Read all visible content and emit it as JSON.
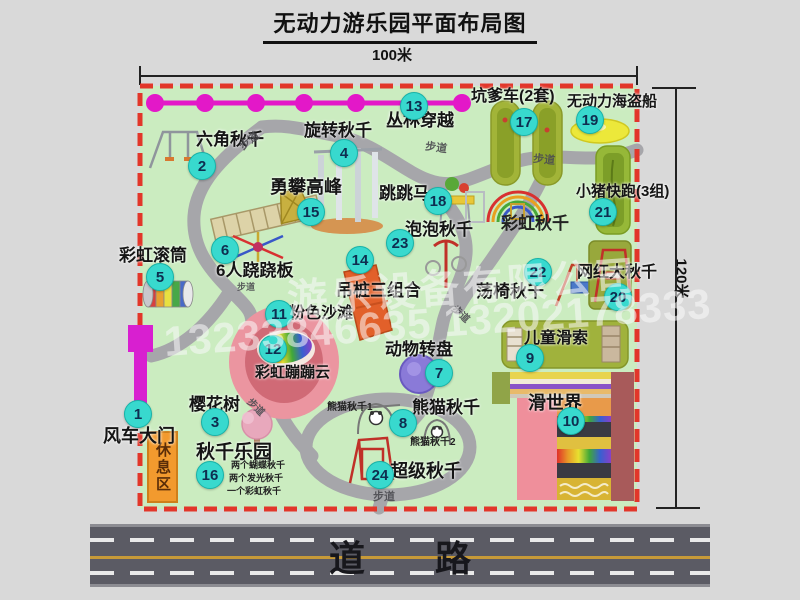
{
  "title": "无动力游乐园平面布局图",
  "dimensions": {
    "top": "100米",
    "right": "120米"
  },
  "road": {
    "label": "道路"
  },
  "rest_area": {
    "label": "休息区"
  },
  "watermark": {
    "line1": "游乐设备有限公司",
    "line2": "13233846635 13202178333"
  },
  "colors": {
    "park_fill": "#cbecc0",
    "boundary": "#e2362a",
    "badge": "#38d9ce",
    "walkway": "#a6a6aa",
    "zipline": "#e318c8",
    "road": "#5b5b64",
    "gate": "#d81fd0",
    "rest_area": "#f29a2e"
  },
  "attractions": [
    {
      "num": 1,
      "label": "风车大门",
      "lx": 103,
      "ly": 427,
      "size": 18,
      "bx": 137,
      "by": 413
    },
    {
      "num": 2,
      "label": "六角秋千",
      "lx": 196,
      "ly": 131,
      "size": 17,
      "bx": 201,
      "by": 165
    },
    {
      "num": 3,
      "label": "樱花树",
      "lx": 189,
      "ly": 396,
      "size": 17,
      "bx": 214,
      "by": 421
    },
    {
      "num": 4,
      "label": "旋转秋千",
      "lx": 304,
      "ly": 122,
      "size": 17,
      "bx": 343,
      "by": 152
    },
    {
      "num": 5,
      "label": "彩虹滚筒",
      "lx": 119,
      "ly": 247,
      "size": 17,
      "bx": 159,
      "by": 276
    },
    {
      "num": 6,
      "label": "6人跷跷板",
      "lx": 216,
      "ly": 262,
      "size": 17,
      "bx": 224,
      "by": 249
    },
    {
      "num": 7,
      "label": "动物转盘",
      "lx": 385,
      "ly": 341,
      "size": 17,
      "bx": 438,
      "by": 372
    },
    {
      "num": 8,
      "label": "熊猫秋千",
      "lx": 412,
      "ly": 399,
      "size": 17,
      "bx": 402,
      "by": 422
    },
    {
      "num": 9,
      "label": "儿童滑索",
      "lx": 524,
      "ly": 331,
      "size": 16,
      "bx": 529,
      "by": 357
    },
    {
      "num": 10,
      "label": "滑世界",
      "lx": 528,
      "ly": 394,
      "size": 18,
      "bx": 570,
      "by": 420
    },
    {
      "num": 11,
      "label": "粉色沙滩",
      "lx": 289,
      "ly": 306,
      "size": 16,
      "bx": 278,
      "by": 313
    },
    {
      "num": 12,
      "label": "彩虹蹦蹦云",
      "lx": 255,
      "ly": 365,
      "size": 15,
      "bx": 272,
      "by": 348
    },
    {
      "num": 13,
      "label": "丛林穿越",
      "lx": 386,
      "ly": 112,
      "size": 17,
      "bx": 413,
      "by": 105
    },
    {
      "num": 14,
      "label": "吊桩三组合",
      "lx": 336,
      "ly": 282,
      "size": 17,
      "bx": 359,
      "by": 259
    },
    {
      "num": 15,
      "label": "勇攀高峰",
      "lx": 270,
      "ly": 178,
      "size": 18,
      "bx": 310,
      "by": 211
    },
    {
      "num": 16,
      "label": "秋千乐园",
      "lx": 196,
      "ly": 443,
      "size": 19,
      "bx": 209,
      "by": 474
    },
    {
      "num": 17,
      "label": "坑爹车(2套)",
      "lx": 471,
      "ly": 89,
      "size": 16,
      "bx": 523,
      "by": 121
    },
    {
      "num": 18,
      "label": "跳跳马",
      "lx": 379,
      "ly": 185,
      "size": 17,
      "bx": 437,
      "by": 200
    },
    {
      "num": 19,
      "label": "无动力海盗船",
      "lx": 567,
      "ly": 94,
      "size": 15,
      "bx": 589,
      "by": 119
    },
    {
      "num": 20,
      "label": "网红大秋千",
      "lx": 577,
      "ly": 265,
      "size": 16,
      "bx": 617,
      "by": 296
    },
    {
      "num": 21,
      "label": "小猪快跑(3组)",
      "lx": 576,
      "ly": 184,
      "size": 15,
      "bx": 602,
      "by": 211
    },
    {
      "num": 22,
      "label": "荡椅秋千",
      "lx": 476,
      "ly": 283,
      "size": 17,
      "bx": 537,
      "by": 271
    },
    {
      "num": 23,
      "label": "泡泡秋千",
      "lx": 405,
      "ly": 221,
      "size": 17,
      "bx": 399,
      "by": 242
    },
    {
      "num": 24,
      "label": "超级秋千",
      "lx": 390,
      "ly": 462,
      "size": 18,
      "bx": 379,
      "by": 474
    }
  ],
  "extra_labels": [
    {
      "text": "彩虹秋千",
      "x": 501,
      "y": 213,
      "size": 17,
      "bold": true
    },
    {
      "text": "熊猫秋千1",
      "x": 327,
      "y": 401,
      "size": 10,
      "bold": true
    },
    {
      "text": "熊猫秋千2",
      "x": 410,
      "y": 436,
      "size": 10,
      "bold": true
    },
    {
      "text": "两个蝴蝶秋千",
      "x": 231,
      "y": 459,
      "size": 9,
      "bold": true
    },
    {
      "text": "两个发光秋千",
      "x": 229,
      "y": 472,
      "size": 9,
      "bold": true
    },
    {
      "text": "一个彩虹秋千",
      "x": 227,
      "y": 485,
      "size": 9,
      "bold": true
    }
  ],
  "walkway_label": "步道",
  "walkway_labels": [
    {
      "x": 239,
      "y": 136,
      "rot": -38,
      "size": 11
    },
    {
      "x": 425,
      "y": 143,
      "rot": 8,
      "size": 11
    },
    {
      "x": 533,
      "y": 155,
      "rot": 6,
      "size": 11
    },
    {
      "x": 237,
      "y": 283,
      "rot": 0,
      "size": 9
    },
    {
      "x": 450,
      "y": 310,
      "rot": 42,
      "size": 10
    },
    {
      "x": 245,
      "y": 403,
      "rot": 45,
      "size": 10
    },
    {
      "x": 373,
      "y": 492,
      "rot": 0,
      "size": 11
    }
  ]
}
